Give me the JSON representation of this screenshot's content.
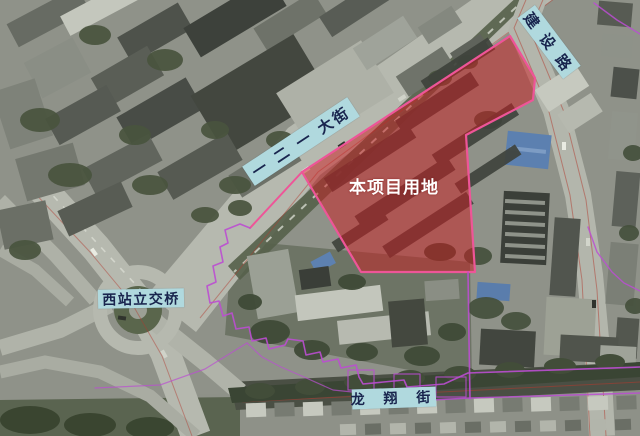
{
  "map_labels": {
    "project_site": "本项目用地",
    "street_dajie": "一 二 一 大街",
    "street_jianshe": "建 设 路",
    "street_longxiang": "龙 翔 街",
    "overpass_xizhan": "西站立交桥"
  },
  "colors": {
    "site_fill": "#cb1b20",
    "site_border": "#ee5598",
    "boundary_line": "#bb4ed2",
    "label_box_bg": "#b0d9de",
    "label_text": "#19254e",
    "site_label_text": "#ffffff"
  },
  "annotations": {
    "site_polygon": "510,36 535,78 533,100 466,135 475,272 361,272 302,172",
    "site_tail": "302,172 250,228",
    "boundary_left_loop": "250,228 240,224 225,230 228,243 220,247 223,262 213,266 216,282 207,286 210,303 219,301 223,316 232,313 236,329 249,327 252,341 266,338 269,349 285,345 288,339 303,341 306,355 320,352 323,362 338,359 341,368 356,365 359,377 363,384 404,380 407,387 444,384 468,373 640,367",
    "boundary_lower_line": "352,404 470,398 640,393",
    "boundary_right_vertical": "468,272 469,340 470,399",
    "boundary_right_mid": "588,227 597,252 612,272 624,283 640,291",
    "boundary_top_right": "594,3 617,20 640,34",
    "boundary_bottom_left_a": "95,388 160,385 205,369 247,343",
    "boundary_bottom_left_b": "247,343 262,357 281,367 304,377 333,390 362,393",
    "boundary_box_a": "348,370 374,370 374,390 348,390 348,370",
    "boundary_box_b": "394,374 420,374 420,392 394,392 394,374",
    "boundary_box_c": "436,377 466,377 466,397 436,397 436,377"
  }
}
